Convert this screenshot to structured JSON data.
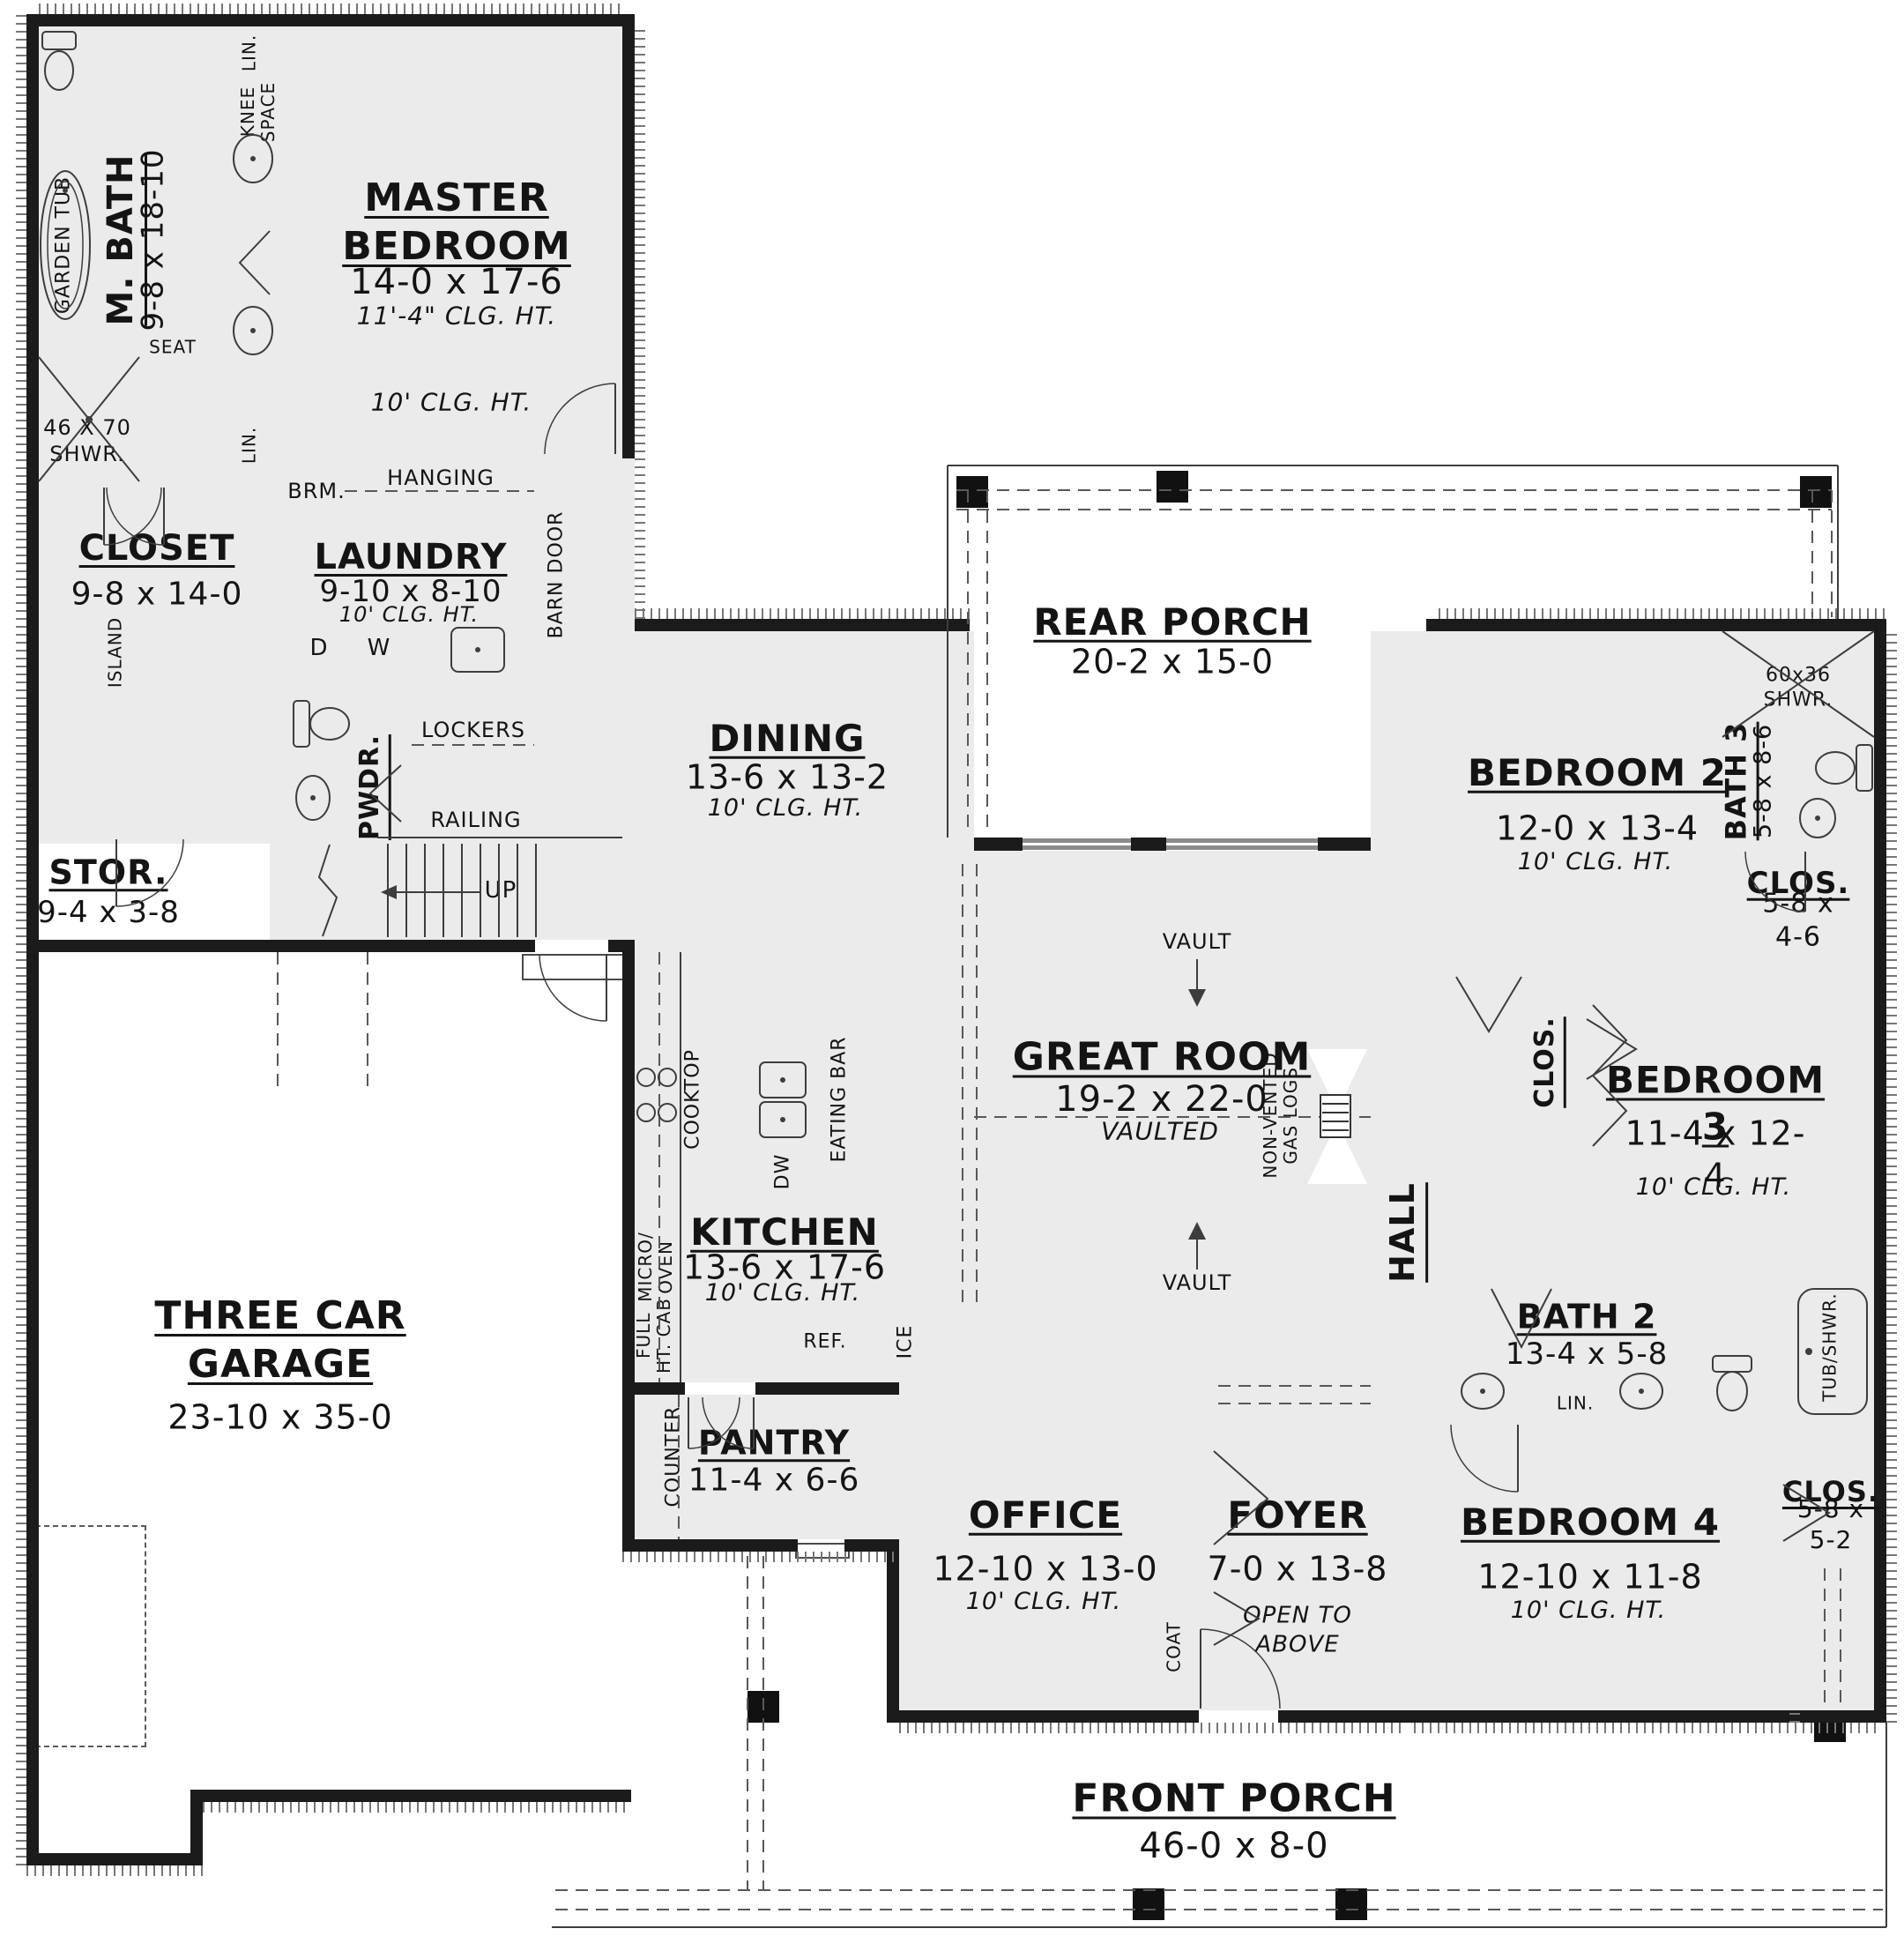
{
  "rooms": {
    "master_bedroom": {
      "name": "MASTER BEDROOM",
      "dims": "14-0 x 17-6",
      "clg": "11'-4\" CLG. HT.",
      "note": "10' CLG. HT."
    },
    "m_bath": {
      "name": "M. BATH",
      "dims": "9-8 x 18-10"
    },
    "closet": {
      "name": "CLOSET",
      "dims": "9-8 x 14-0"
    },
    "laundry": {
      "name": "LAUNDRY",
      "dims": "9-10 x 8-10",
      "clg": "10' CLG. HT."
    },
    "pwdr": {
      "name": "PWDR."
    },
    "stor": {
      "name": "STOR.",
      "dims": "9-4 x 3-8"
    },
    "garage": {
      "name": "THREE CAR\nGARAGE",
      "dims": "23-10 x 35-0"
    },
    "dining": {
      "name": "DINING",
      "dims": "13-6 x 13-2",
      "clg": "10' CLG. HT."
    },
    "kitchen": {
      "name": "KITCHEN",
      "dims": "13-6 x 17-6",
      "clg": "10' CLG. HT."
    },
    "pantry": {
      "name": "PANTRY",
      "dims": "11-4 x 6-6"
    },
    "rear_porch": {
      "name": "REAR PORCH",
      "dims": "20-2 x 15-0"
    },
    "great_room": {
      "name": "GREAT ROOM",
      "dims": "19-2 x 22-0",
      "vaulted": "VAULTED"
    },
    "hall": {
      "name": "HALL"
    },
    "bedroom2": {
      "name": "BEDROOM 2",
      "dims": "12-0 x 13-4",
      "clg": "10' CLG. HT."
    },
    "bath3": {
      "name": "BATH 3",
      "dims": "5-8 x 8-6"
    },
    "clos2": {
      "name": "CLOS.",
      "dims": "5-8 x 4-6"
    },
    "bedroom3": {
      "name": "BEDROOM 3",
      "dims": "11-4 x 12-4",
      "clg": "10' CLG. HT."
    },
    "clos3": {
      "name": "CLOS."
    },
    "bath2": {
      "name": "BATH 2",
      "dims": "13-4 x 5-8"
    },
    "bedroom4": {
      "name": "BEDROOM 4",
      "dims": "12-10 x 11-8",
      "clg": "10' CLG. HT."
    },
    "clos4": {
      "name": "CLOS.",
      "dims": "5-8 x 5-2"
    },
    "office": {
      "name": "OFFICE",
      "dims": "12-10 x 13-0",
      "clg": "10' CLG. HT."
    },
    "foyer": {
      "name": "FOYER",
      "dims": "7-0 x 13-8",
      "note": "OPEN TO\nABOVE"
    },
    "front_porch": {
      "name": "FRONT PORCH",
      "dims": "46-0 x 8-0"
    }
  },
  "fixtures": {
    "garden_tub": "GARDEN TUB",
    "seat": "SEAT",
    "master_shower": "46 X 70\nSHWR.",
    "knee_space": "KNEE\nSPACE",
    "lin": "LIN.",
    "island": "ISLAND",
    "brm": "BRM.",
    "hanging": "HANGING",
    "d": "D",
    "w": "W",
    "barn_door": "BARN DOOR",
    "lockers": "LOCKERS",
    "railing": "RAILING",
    "up": "UP",
    "cooktop": "COOKTOP",
    "eating_bar": "EATING BAR",
    "dw": "DW",
    "micro_oven": "MICRO/\nOVEN",
    "full_cab": "FULL\nHT. CAB",
    "ref": "REF.",
    "ice": "ICE",
    "counter": "COUNTER",
    "coat": "COAT",
    "vault": "VAULT",
    "gas_logs": "NON-VENTED\nGAS LOGS",
    "shower_6036": "60x36 SHWR.",
    "tub_shwr": "TUB/SHWR."
  },
  "colors": {
    "wall": "#1b1b1b",
    "floor": "#ebebeb",
    "paper": "#ffffff",
    "line": "#4a4a4a"
  }
}
